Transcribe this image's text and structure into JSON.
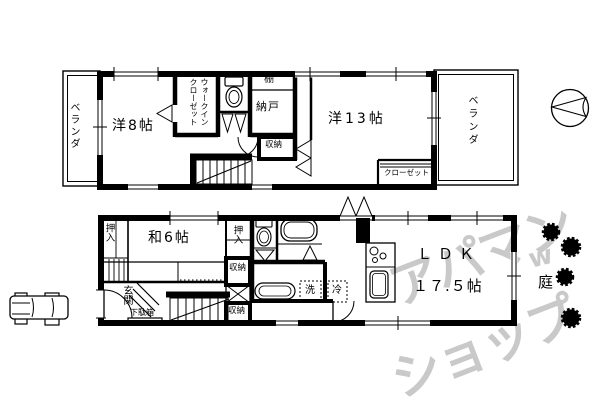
{
  "colors": {
    "background": "#ffffff",
    "line": "#000000",
    "watermark": "#c9c9c9"
  },
  "floor2": {
    "balcony_left": "ベランダ",
    "room8": "洋8帖",
    "walk_in_closet": "ウォークインクローゼット",
    "shelf": "棚",
    "storage_room": "納戸",
    "storage": "収納",
    "room13": "洋13帖",
    "closet": "クローゼット",
    "balcony_right": "ベランダ"
  },
  "floor1": {
    "oshiire_left": "押入",
    "japanese_room": "和6帖",
    "oshiire_right": "押入",
    "storage_upper": "収納",
    "storage_lower": "収納",
    "entrance": "玄関",
    "shoe_cabinet": "下駄箱",
    "ldk": "ＬＤＫ",
    "ldk_size": "１７.５帖",
    "washer": "洗",
    "fridge": "冷"
  },
  "outside": {
    "garden": "庭"
  },
  "watermark": {
    "line1": "アパマン",
    "line2": "ショップ",
    "mark": "w"
  },
  "icons": {
    "compass": "compass-icon",
    "car": "car-icon",
    "tree": "tree-icon",
    "toilet": "toilet-icon",
    "bathtub": "bathtub-icon",
    "washbasin": "washbasin-icon",
    "kitchen_sink": "kitchen-sink-icon",
    "stove": "stove-icon",
    "stairs": "stairs-icon",
    "door_swing": "door-swing-icon"
  }
}
